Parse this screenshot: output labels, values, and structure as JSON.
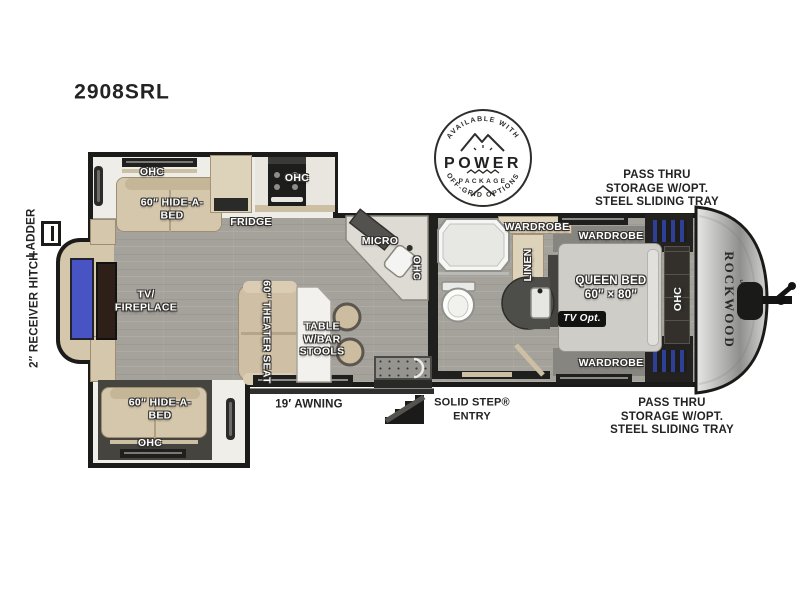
{
  "title": "2908SRL",
  "badge": {
    "arc_top": "AVAILABLE WITH",
    "word": "POWER",
    "package": "PACKAGE",
    "arc_bottom": "OFF-GRID OPTIONS"
  },
  "exterior": {
    "ladder": "LADDER",
    "receiver_hitch": "2″ RECEIVER HITCH",
    "pass_thru": [
      "PASS THRU",
      "STORAGE W/OPT.",
      "STEEL SLIDING TRAY"
    ],
    "awning": "19′ AWNING",
    "solid_step": [
      "SOLID STEP®",
      "ENTRY"
    ],
    "brand": "ROCKWOOD",
    "brand_sub": "ULTRA LITE"
  },
  "labels": {
    "ohc": "OHC",
    "hide_a_bed": [
      "60″ HIDE-A-",
      "BED"
    ],
    "fridge": "FRIDGE",
    "micro": "MICRO",
    "wardrobe": "WARDROBE",
    "linen": "LINEN",
    "queen_bed": [
      "QUEEN BED",
      "60″ × 80″"
    ],
    "tv_opt": "TV Opt.",
    "tv_fireplace": [
      "TV/",
      "FIREPLACE"
    ],
    "theater_seat": "60″ THEATER SEAT",
    "table": [
      "TABLE",
      "W/BAR",
      "STOOLS"
    ]
  },
  "colors": {
    "wall": "#1b1b19",
    "floor": "#a5a19b",
    "furniture_tan": "#d5c7ac",
    "slide_floor": "#45443f",
    "tv_blue": "#4853c4",
    "storage_vent_blue": "#2f3f96",
    "front_cap_silver": "#b9b9b7",
    "label_white": "#ffffff",
    "exterior_text": "#232323"
  }
}
